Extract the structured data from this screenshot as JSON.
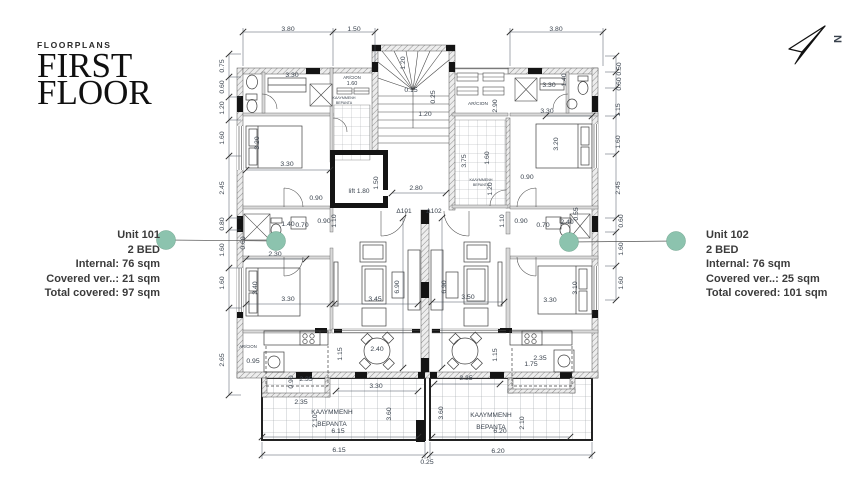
{
  "title": {
    "eyebrow": "FLOORPLANS",
    "line1": "FIRST",
    "line2": "FLOOR"
  },
  "north_arrow": {
    "label": "N"
  },
  "units": [
    {
      "name": "Unit 101",
      "beds": "2 BED",
      "internal": "Internal: 76 sqm",
      "covered": "Covered ver..: 21 sqm",
      "total": "Total covered:  97 sqm"
    },
    {
      "name": "Unit 102",
      "beds": "2 BED",
      "internal": "Internal: 76 sqm",
      "covered": "Covered ver..: 25 sqm",
      "total": "Total covered: 101 sqm"
    }
  ],
  "colors": {
    "accent": "#8CC3AE",
    "ink": "#39424D"
  },
  "plan": {
    "labels": [
      {
        "x": 288,
        "y": 31,
        "t": "3.80"
      },
      {
        "x": 354,
        "y": 31,
        "t": "1.50"
      },
      {
        "x": 556,
        "y": 31,
        "t": "3.80"
      },
      {
        "x": 224,
        "y": 66,
        "t": "0.75",
        "r": -90
      },
      {
        "x": 224,
        "y": 87,
        "t": "0.60",
        "r": -90
      },
      {
        "x": 224,
        "y": 108,
        "t": "1.20",
        "r": -90
      },
      {
        "x": 224,
        "y": 138,
        "t": "1.60",
        "r": -90
      },
      {
        "x": 224,
        "y": 188,
        "t": "2.45",
        "r": -90
      },
      {
        "x": 224,
        "y": 224,
        "t": "0.80",
        "r": -90
      },
      {
        "x": 224,
        "y": 250,
        "t": "1.60",
        "r": -90
      },
      {
        "x": 224,
        "y": 283,
        "t": "1.60",
        "r": -90
      },
      {
        "x": 224,
        "y": 360,
        "t": "2.65",
        "r": -90
      },
      {
        "x": 621,
        "y": 69,
        "t": "0.50",
        "r": -90
      },
      {
        "x": 621,
        "y": 84,
        "t": "0.60",
        "r": -90
      },
      {
        "x": 620,
        "y": 110,
        "t": "1.15",
        "r": -90
      },
      {
        "x": 620,
        "y": 142,
        "t": "1.60",
        "r": -90
      },
      {
        "x": 620,
        "y": 188,
        "t": "2.45",
        "r": -90
      },
      {
        "x": 623,
        "y": 221,
        "t": "0.60",
        "r": -90
      },
      {
        "x": 623,
        "y": 249,
        "t": "1.60",
        "r": -90
      },
      {
        "x": 623,
        "y": 283,
        "t": "1.60",
        "r": -90
      },
      {
        "x": 292,
        "y": 77,
        "t": "3.30"
      },
      {
        "x": 287,
        "y": 166,
        "t": "3.30"
      },
      {
        "x": 259,
        "y": 143,
        "t": "3.20",
        "r": -90
      },
      {
        "x": 316,
        "y": 200,
        "t": "0.90"
      },
      {
        "x": 288,
        "y": 226,
        "t": "1.40"
      },
      {
        "x": 302,
        "y": 227,
        "t": "0.70"
      },
      {
        "x": 324,
        "y": 223,
        "t": "0.90"
      },
      {
        "x": 336,
        "y": 221,
        "t": "1.10",
        "r": -90
      },
      {
        "x": 245,
        "y": 243,
        "t": "0.60",
        "r": -90
      },
      {
        "x": 275,
        "y": 256,
        "t": "2.30"
      },
      {
        "x": 257,
        "y": 288,
        "t": "3.40",
        "r": -90
      },
      {
        "x": 288,
        "y": 301,
        "t": "3.30"
      },
      {
        "x": 253,
        "y": 363,
        "t": "0.95"
      },
      {
        "x": 342,
        "y": 354,
        "t": "1.15",
        "r": -90
      },
      {
        "x": 377,
        "y": 351,
        "t": "2.40"
      },
      {
        "x": 306,
        "y": 381,
        "t": "2.35"
      },
      {
        "x": 293,
        "y": 382,
        "t": "0.90",
        "r": -90
      },
      {
        "x": 301,
        "y": 404,
        "t": "2.35"
      },
      {
        "x": 317,
        "y": 421,
        "t": "2.10",
        "r": -90
      },
      {
        "x": 376,
        "y": 388,
        "t": "3.30"
      },
      {
        "x": 391,
        "y": 414,
        "t": "3.60",
        "r": -90
      },
      {
        "x": 338,
        "y": 433,
        "t": "6.15"
      },
      {
        "x": 339,
        "y": 452,
        "t": "6.15"
      },
      {
        "x": 359,
        "y": 193,
        "t": "lift 1.80",
        "fs": 6.5
      },
      {
        "x": 378,
        "y": 183,
        "t": "1.50",
        "r": -90
      },
      {
        "x": 416,
        "y": 190,
        "t": "2.80"
      },
      {
        "x": 404,
        "y": 213,
        "t": "Δ101",
        "fs": 6.5,
        "c": "#222"
      },
      {
        "x": 434,
        "y": 213,
        "t": "Δ102",
        "fs": 6.5,
        "c": "#222"
      },
      {
        "x": 399,
        "y": 287,
        "t": "6.90",
        "r": -90
      },
      {
        "x": 375,
        "y": 301,
        "t": "3.45"
      },
      {
        "x": 446,
        "y": 287,
        "t": "6.90",
        "r": -90
      },
      {
        "x": 468,
        "y": 299,
        "t": "3.50"
      },
      {
        "x": 405,
        "y": 63,
        "t": "1.20",
        "r": -90
      },
      {
        "x": 411,
        "y": 92,
        "t": "0.15"
      },
      {
        "x": 435,
        "y": 97,
        "t": "0.25",
        "r": -90
      },
      {
        "x": 425,
        "y": 116,
        "t": "1.20"
      },
      {
        "x": 497,
        "y": 106,
        "t": "2.90",
        "r": -90
      },
      {
        "x": 466,
        "y": 161,
        "t": "3.75",
        "r": -90
      },
      {
        "x": 489,
        "y": 158,
        "t": "1.60",
        "r": -90
      },
      {
        "x": 492,
        "y": 189,
        "t": "1.20",
        "r": -90
      },
      {
        "x": 527,
        "y": 179,
        "t": "0.90"
      },
      {
        "x": 521,
        "y": 223,
        "t": "0.90"
      },
      {
        "x": 504,
        "y": 221,
        "t": "1.10",
        "r": -90
      },
      {
        "x": 549,
        "y": 87,
        "t": "3.30"
      },
      {
        "x": 566,
        "y": 80,
        "t": "1.40",
        "r": -90
      },
      {
        "x": 547,
        "y": 113,
        "t": "3.30"
      },
      {
        "x": 558,
        "y": 144,
        "t": "3.20",
        "r": -90
      },
      {
        "x": 543,
        "y": 227,
        "t": "0.70"
      },
      {
        "x": 567,
        "y": 224,
        "t": "2.40"
      },
      {
        "x": 578,
        "y": 214,
        "t": "0.55",
        "r": -90
      },
      {
        "x": 577,
        "y": 288,
        "t": "3.10",
        "r": -90
      },
      {
        "x": 550,
        "y": 302,
        "t": "3.30"
      },
      {
        "x": 540,
        "y": 360,
        "t": "2.35"
      },
      {
        "x": 531,
        "y": 366,
        "t": "1.75"
      },
      {
        "x": 497,
        "y": 355,
        "t": "1.15",
        "r": -90
      },
      {
        "x": 466,
        "y": 380,
        "t": "3.35"
      },
      {
        "x": 443,
        "y": 413,
        "t": "3.60",
        "r": -90
      },
      {
        "x": 524,
        "y": 423,
        "t": "2.10",
        "r": -90
      },
      {
        "x": 500,
        "y": 433,
        "t": "6.20"
      },
      {
        "x": 498,
        "y": 453,
        "t": "6.20"
      },
      {
        "x": 427,
        "y": 464,
        "t": "0.25"
      },
      {
        "x": 352,
        "y": 79,
        "t": "AR/CION",
        "fs": 4.2
      },
      {
        "x": 352,
        "y": 85,
        "t": "1.60",
        "fs": 5.5
      },
      {
        "x": 344,
        "y": 99,
        "t": "ΚΑΛΥΜΜΕΝΗ",
        "fs": 3.6,
        "c": "#777"
      },
      {
        "x": 344,
        "y": 104,
        "t": "ΒΕΡΑΝΤΑ",
        "fs": 3.6,
        "c": "#777"
      },
      {
        "x": 478,
        "y": 105,
        "t": "AR/CION",
        "fs": 4.8
      },
      {
        "x": 481,
        "y": 181,
        "t": "ΚΑΛΥΜΜΕΝΗ",
        "fs": 3.6,
        "c": "#777"
      },
      {
        "x": 481,
        "y": 186,
        "t": "ΒΕΡΑΝΤΑ",
        "fs": 3.6,
        "c": "#777"
      },
      {
        "x": 248,
        "y": 348,
        "t": "AR/CION",
        "fs": 4.2
      },
      {
        "x": 332,
        "y": 414,
        "t": "ΚΑΛΥΜΜΕΝΗ",
        "fs": 6.5,
        "c": "#6d7276"
      },
      {
        "x": 332,
        "y": 426,
        "t": "ΒΕΡΑΝΤΑ",
        "fs": 6.5,
        "c": "#6d7276"
      },
      {
        "x": 491,
        "y": 417,
        "t": "ΚΑΛΥΜΜΕΝΗ",
        "fs": 6.5,
        "c": "#6d7276"
      },
      {
        "x": 491,
        "y": 429,
        "t": "ΒΕΡΑΝΤΑ",
        "fs": 6.5,
        "c": "#6d7276"
      }
    ]
  }
}
